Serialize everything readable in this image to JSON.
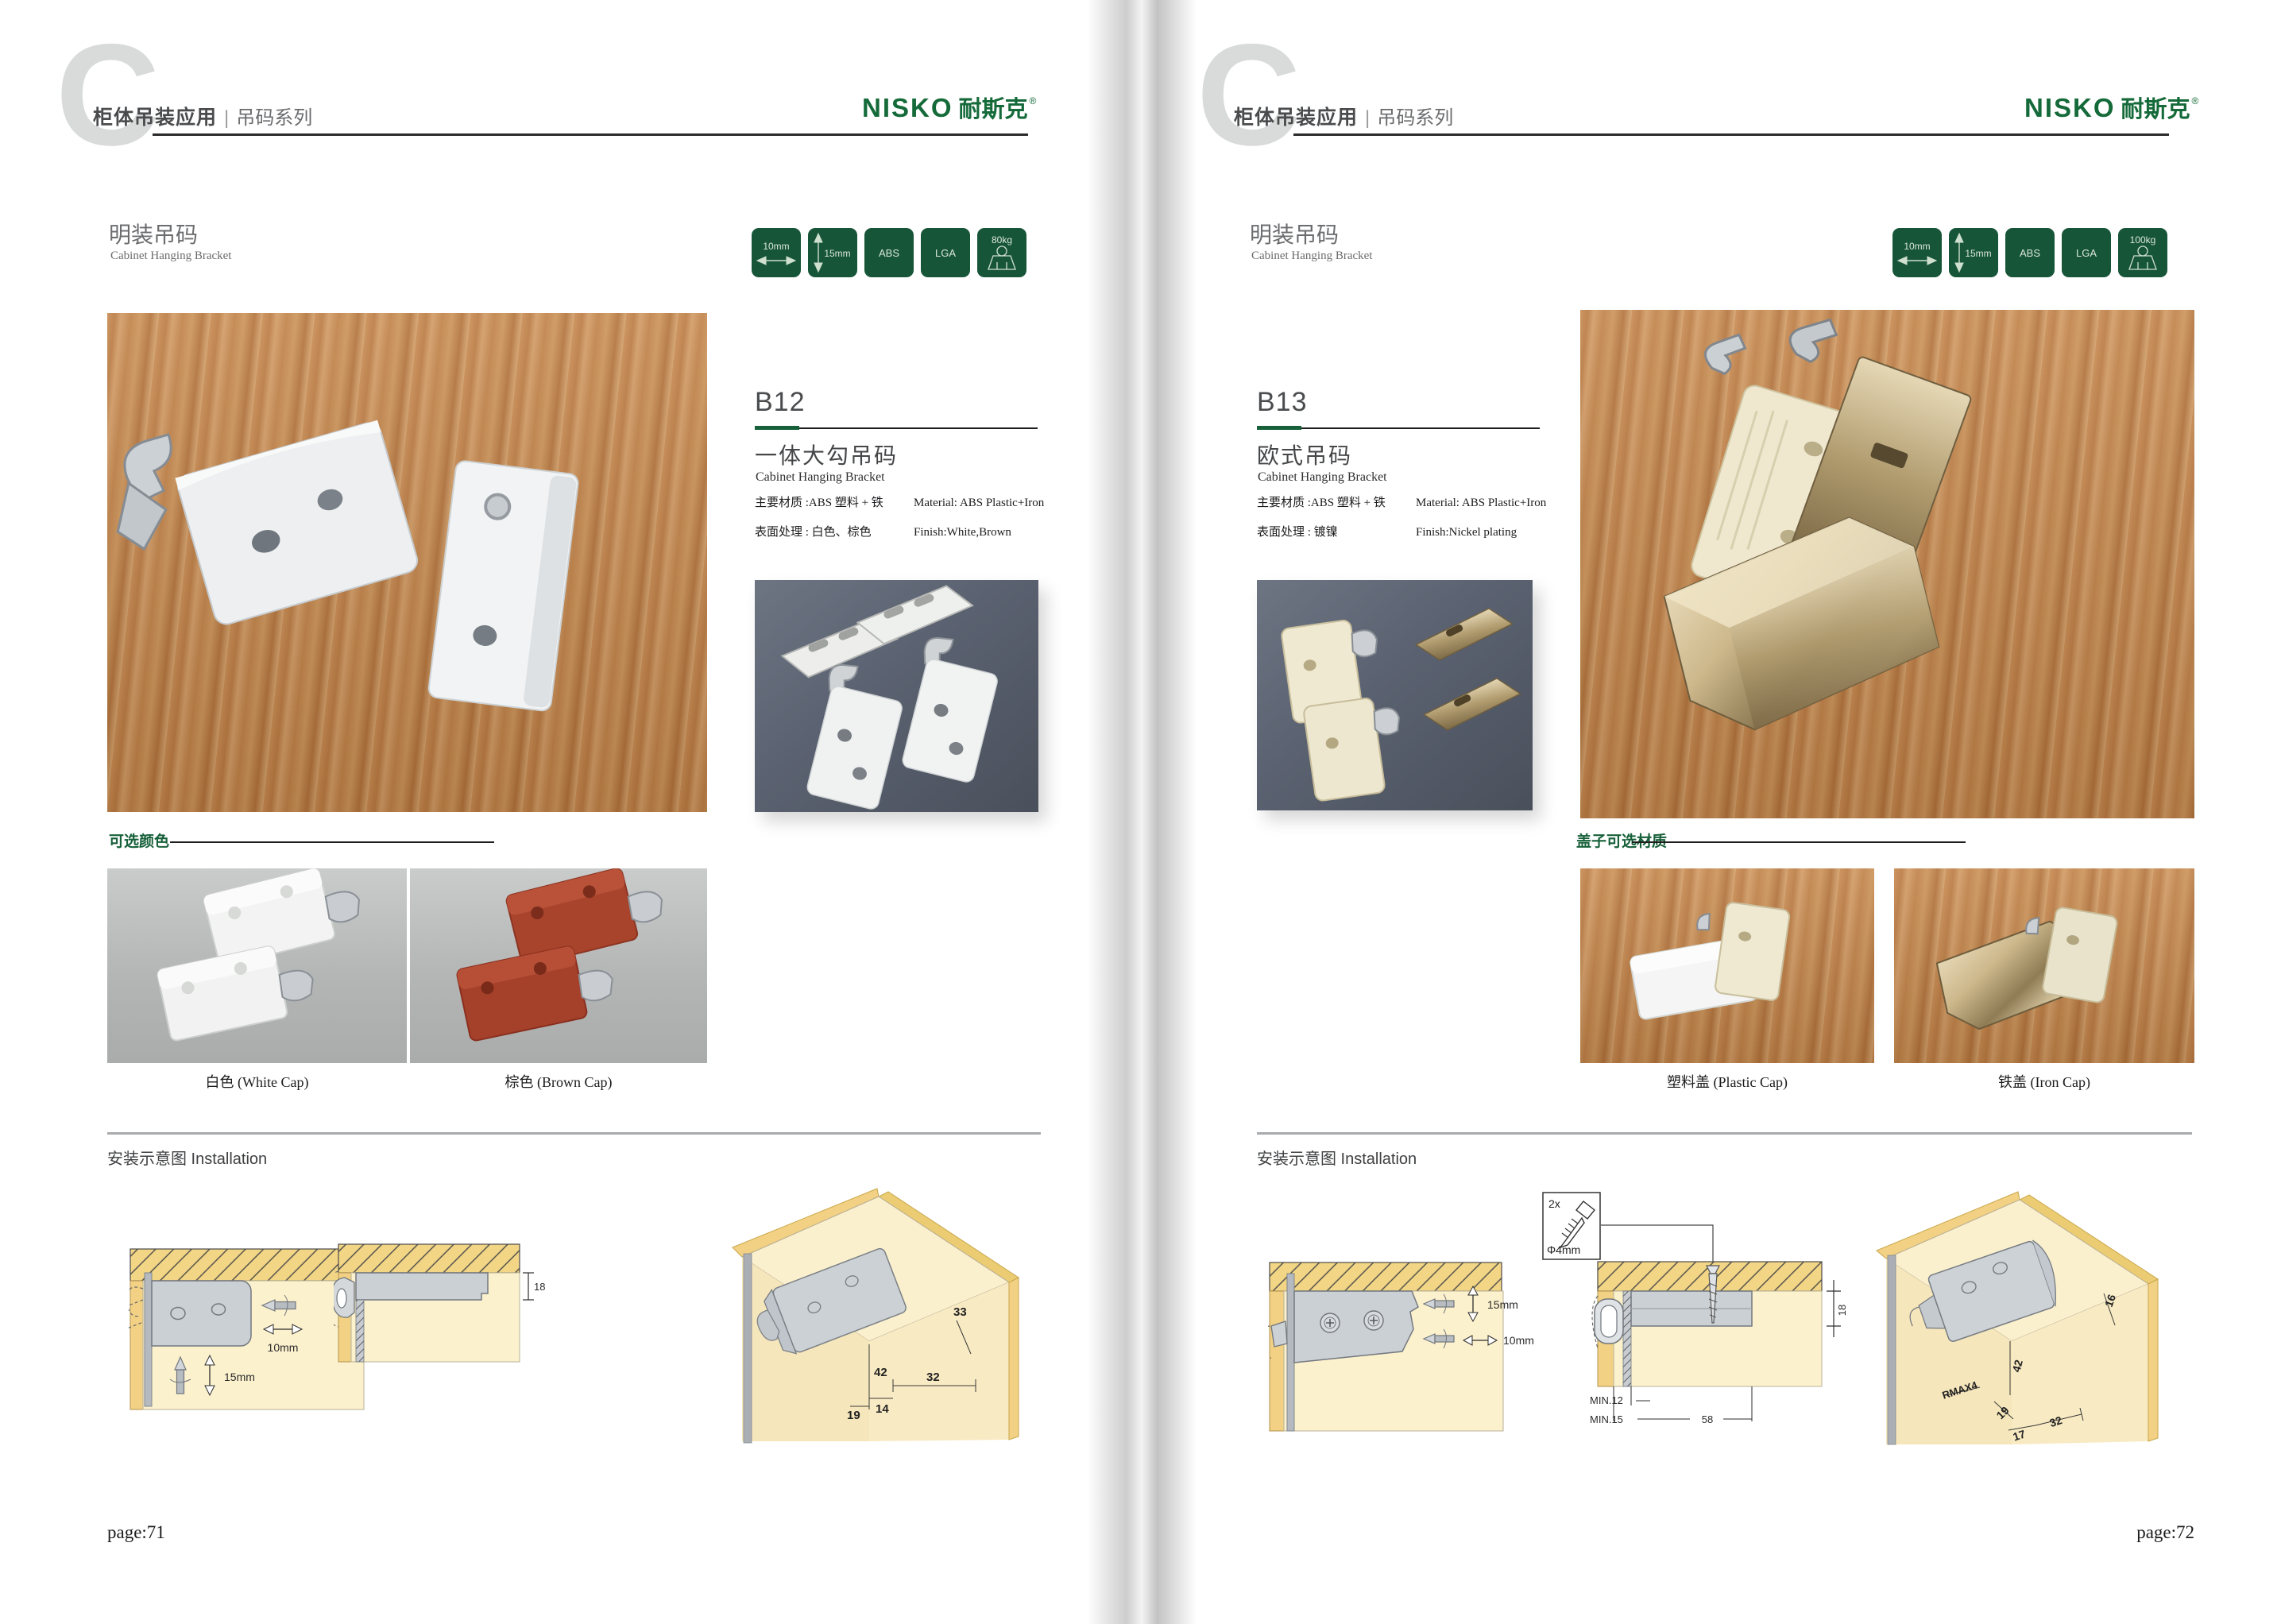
{
  "pages": [
    {
      "big_letter": "C",
      "header": {
        "bold": "柜体吊装应用",
        "divider": "|",
        "light": "吊码系列"
      },
      "logo": {
        "en": "NISKO",
        "cn": "耐斯克",
        "reg": "®"
      },
      "section": {
        "cn": "明装吊码",
        "en": "Cabinet Hanging Bracket"
      },
      "badges": [
        {
          "text": "10mm"
        },
        {
          "text": "15mm"
        },
        {
          "text": "ABS"
        },
        {
          "text": "LGA"
        },
        {
          "text": "80kg"
        }
      ],
      "product": {
        "code": "B12",
        "name_cn": "一体大勾吊码",
        "name_en": "Cabinet Hanging Bracket",
        "specs": [
          {
            "cn": "主要材质 :ABS 塑料 + 铁",
            "en": "Material: ABS Plastic+Iron"
          },
          {
            "cn": "表面处理 : 白色、棕色",
            "en": "Finish:White,Brown"
          }
        ]
      },
      "options": {
        "label": "可选颜色",
        "captions": [
          "白色 (White Cap)",
          "棕色 (Brown Cap)"
        ]
      },
      "install": {
        "heading": "安装示意图 Installation",
        "d1": {
          "h": "10mm",
          "v": "15mm"
        },
        "d2": {
          "t": "18"
        },
        "d3": {
          "a": "33",
          "b": "42",
          "c": "32",
          "d": "14",
          "e": "19"
        }
      },
      "page_label": "page:71"
    },
    {
      "big_letter": "C",
      "header": {
        "bold": "柜体吊装应用",
        "divider": "|",
        "light": "吊码系列"
      },
      "logo": {
        "en": "NISKO",
        "cn": "耐斯克",
        "reg": "®"
      },
      "section": {
        "cn": "明装吊码",
        "en": "Cabinet Hanging Bracket"
      },
      "badges": [
        {
          "text": "10mm"
        },
        {
          "text": "15mm"
        },
        {
          "text": "ABS"
        },
        {
          "text": "LGA"
        },
        {
          "text": "100kg"
        }
      ],
      "product": {
        "code": "B13",
        "name_cn": "欧式吊码",
        "name_en": "Cabinet Hanging Bracket",
        "specs": [
          {
            "cn": "主要材质 :ABS 塑料 + 铁",
            "en": "Material: ABS Plastic+Iron"
          },
          {
            "cn": "表面处理 : 镀镍",
            "en": "Finish:Nickel plating"
          }
        ]
      },
      "options": {
        "label": "盖子可选材质",
        "captions": [
          "塑料盖 (Plastic Cap)",
          "铁盖 (Iron Cap)"
        ]
      },
      "install": {
        "heading": "安装示意图 Installation",
        "screw": {
          "count": "2x",
          "dia": "Φ4mm"
        },
        "d1": {
          "v": "15mm",
          "h": "10mm"
        },
        "d2": {
          "t": "18",
          "min1": "MIN.12",
          "min2": "MIN.15",
          "w": "58"
        },
        "d3": {
          "a": "16",
          "b": "42",
          "c": "RMAX4",
          "d": "19",
          "e": "17",
          "f": "32"
        }
      },
      "page_label": "page:72"
    }
  ]
}
